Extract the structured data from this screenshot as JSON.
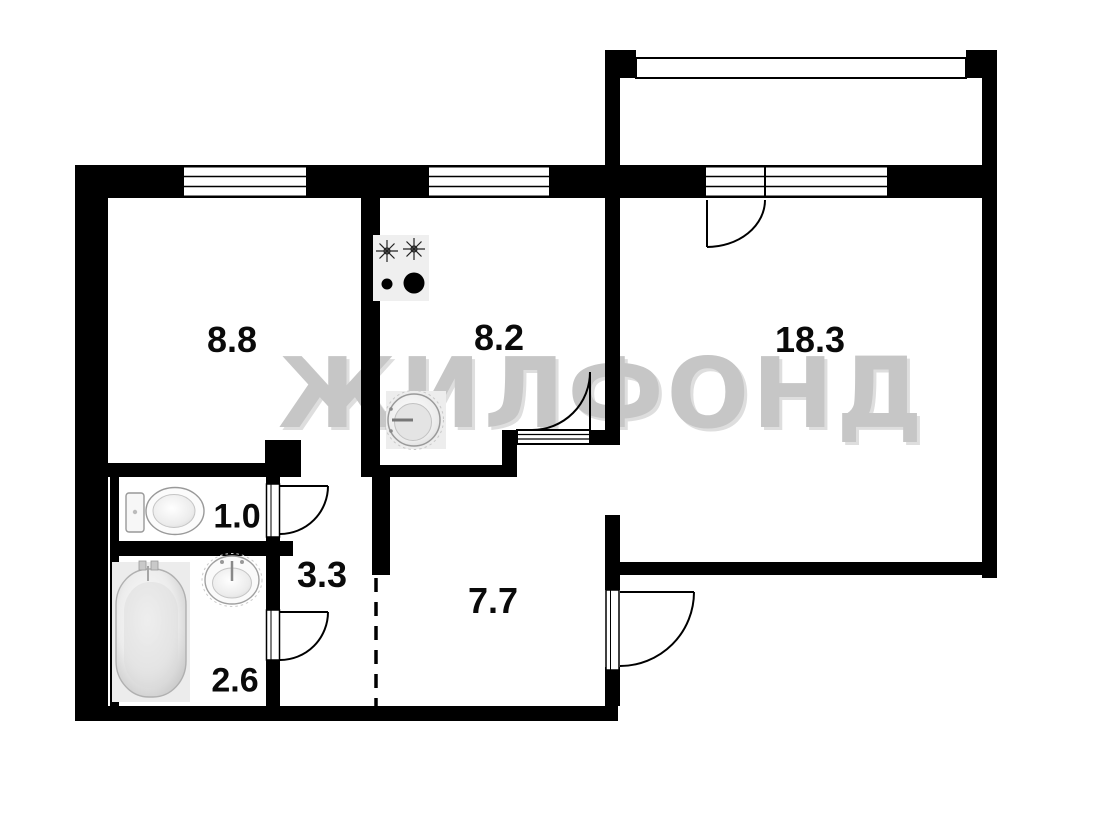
{
  "watermark": {
    "text": "ЖИЛФОНД"
  },
  "plan": {
    "rooms": [
      {
        "name": "living-room",
        "label": "8.8",
        "area_m2": 8.8
      },
      {
        "name": "kitchen",
        "label": "8.2",
        "area_m2": 8.2
      },
      {
        "name": "main-room",
        "label": "18.3",
        "area_m2": 18.3
      },
      {
        "name": "toilet",
        "label": "1.0",
        "area_m2": 1.0
      },
      {
        "name": "hallway",
        "label": "3.3",
        "area_m2": 3.3
      },
      {
        "name": "bathroom",
        "label": "2.6",
        "area_m2": 2.6
      },
      {
        "name": "corridor",
        "label": "7.7",
        "area_m2": 7.7
      }
    ],
    "fixtures": [
      "stove",
      "kitchen-sink",
      "toilet",
      "bathtub",
      "bathroom-sink"
    ],
    "colors": {
      "wall": "#000000",
      "background": "#ffffff",
      "watermark": "#c6c6c6",
      "fixture_fill": "#ededed"
    }
  }
}
